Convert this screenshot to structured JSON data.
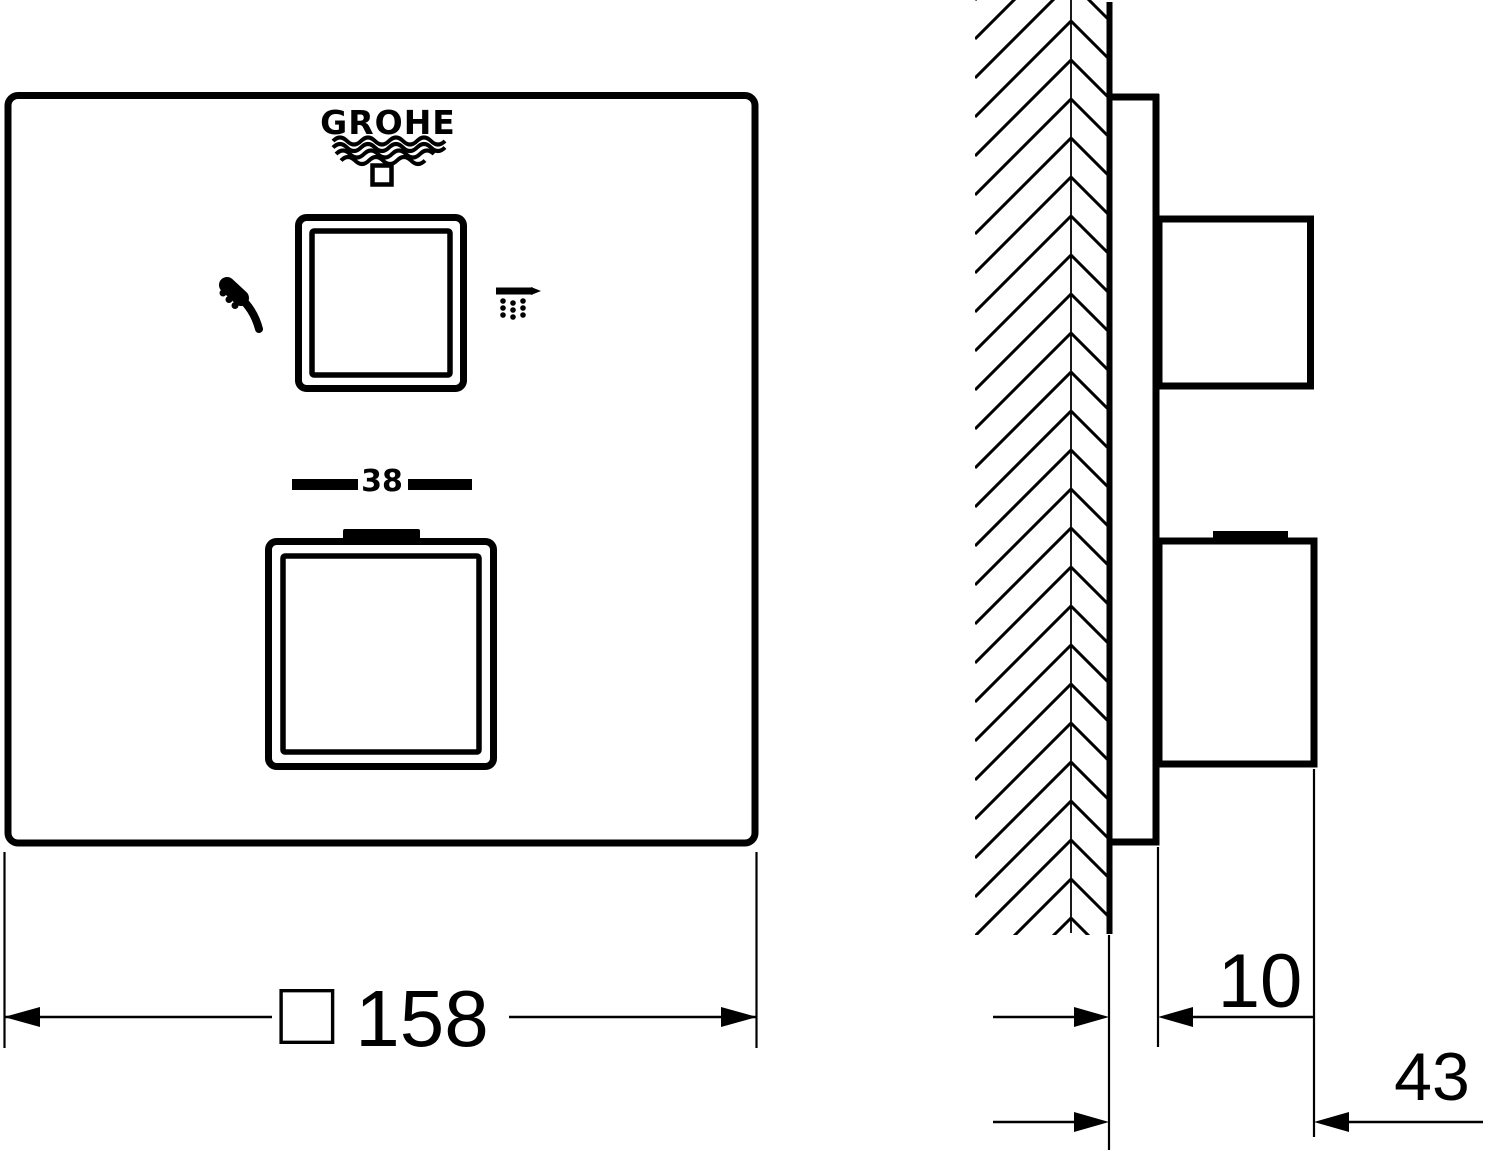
{
  "drawing": {
    "type": "technical-dimension-drawing",
    "brand": "GROHE",
    "front": {
      "temperature_stop": "38",
      "icons": [
        "hand-shower-icon",
        "overhead-shower-icon",
        "square-button-icon"
      ]
    },
    "side": {
      "wall_hatching": "herringbone"
    },
    "dimensions": {
      "front_width_symbol": "□",
      "front_width": "158",
      "front_width_label": "□ 158",
      "plate_depth": "10",
      "total_depth": "43"
    },
    "colors": {
      "line": "#000000",
      "background": "#ffffff"
    }
  }
}
